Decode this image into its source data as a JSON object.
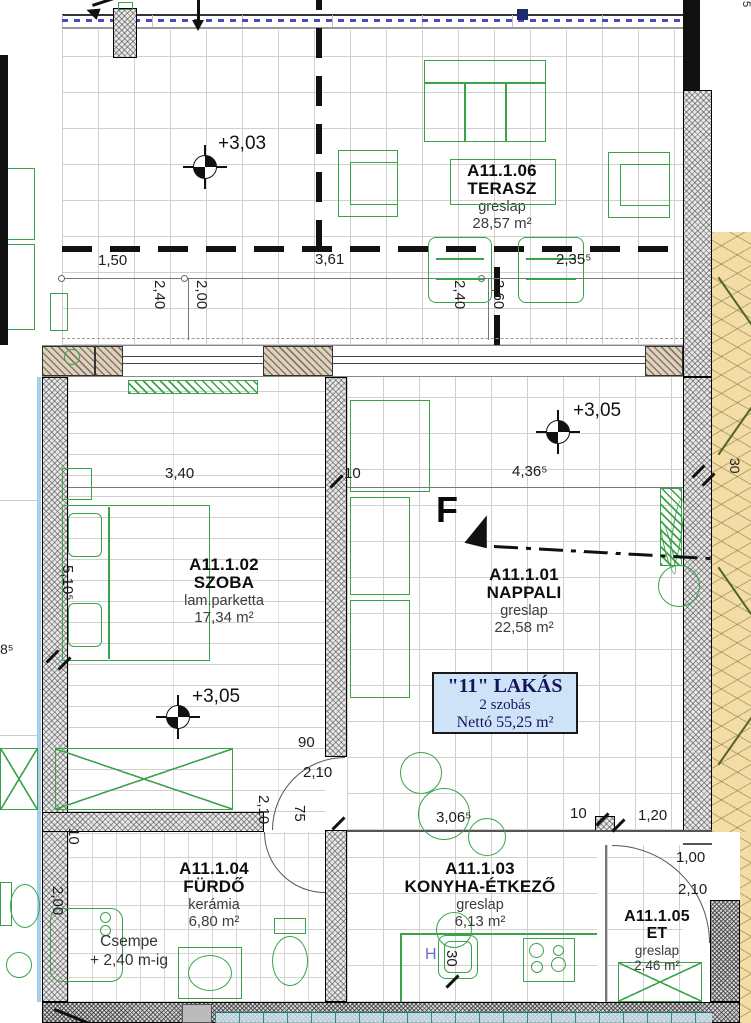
{
  "rooms": [
    {
      "code": "A11.1.06",
      "name": "TERASZ",
      "finish": "greslap",
      "area": "28,57 m²"
    },
    {
      "code": "A11.1.02",
      "name": "SZOBA",
      "finish": "lam.parketta",
      "area": "17,34 m²"
    },
    {
      "code": "A11.1.01",
      "name": "NAPPALI",
      "finish": "greslap",
      "area": "22,58 m²"
    },
    {
      "code": "A11.1.04",
      "name": "FÜRDŐ",
      "finish": "kerámia",
      "area": "6,80 m²"
    },
    {
      "code": "A11.1.03",
      "name": "KONYHA-ÉTKEZŐ",
      "finish": "greslap",
      "area": "6,13 m²"
    },
    {
      "code": "A11.1.05",
      "name": "ET",
      "finish": "greslap",
      "area": "2,46 m²"
    }
  ],
  "apartment_tag": {
    "title": "\"11\" LAKÁS",
    "rooms_count": "2 szobás",
    "net_area": "Nettó 55,25 m²"
  },
  "levels": [
    {
      "label": "+3,03"
    },
    {
      "label": "+3,05"
    },
    {
      "label": "+3,05"
    }
  ],
  "section_marker": {
    "letter": "F"
  },
  "notes": {
    "tiles_line1": "Csempe",
    "tiles_line2": "+ 2,40 m-ig",
    "hot_water": "H"
  },
  "dimensions": [
    {
      "t": "1,50",
      "x": 98,
      "y": 253
    },
    {
      "t": "3,61",
      "x": 315,
      "y": 252
    },
    {
      "t": "2,35⁵",
      "x": 556,
      "y": 252
    },
    {
      "t": "2,40",
      "x": 152,
      "y": 280,
      "v": true
    },
    {
      "t": "2,00",
      "x": 194,
      "y": 280,
      "v": true
    },
    {
      "t": "2,40",
      "x": 452,
      "y": 280,
      "v": true
    },
    {
      "t": "3,60",
      "x": 491,
      "y": 280,
      "v": true
    },
    {
      "t": "3,40",
      "x": 165,
      "y": 466
    },
    {
      "t": "10",
      "x": 344,
      "y": 466
    },
    {
      "t": "4,36⁵",
      "x": 512,
      "y": 464
    },
    {
      "t": "5,10⁵",
      "x": 60,
      "y": 565,
      "v": true
    },
    {
      "t": "90",
      "x": 298,
      "y": 735
    },
    {
      "t": "2,10",
      "x": 303,
      "y": 765
    },
    {
      "t": "2,10",
      "x": 256,
      "y": 795,
      "v": true
    },
    {
      "t": "75",
      "x": 292,
      "y": 805,
      "v": true
    },
    {
      "t": "3,06⁵",
      "x": 436,
      "y": 810
    },
    {
      "t": "10",
      "x": 570,
      "y": 806
    },
    {
      "t": "1,20",
      "x": 638,
      "y": 808
    },
    {
      "t": "1,00",
      "x": 676,
      "y": 850
    },
    {
      "t": "2,10",
      "x": 678,
      "y": 882
    },
    {
      "t": "10",
      "x": 66,
      "y": 828,
      "v": true
    },
    {
      "t": "2,00",
      "x": 50,
      "y": 886,
      "v": true
    },
    {
      "t": "30",
      "x": 444,
      "y": 950,
      "v": true
    },
    {
      "t": "8⁵",
      "x": 0,
      "y": 642,
      "s": 14
    },
    {
      "t": "30",
      "x": 728,
      "y": 458,
      "v": true,
      "s": 14
    },
    {
      "t": "5",
      "x": 740,
      "y": 1,
      "v": true,
      "s": 11
    }
  ],
  "colors": {
    "furniture_green": "#3aa34a",
    "tag_bg": "#cfe3f8",
    "railing_blue": "#4949c8",
    "terrain_tan": "#f4dca6",
    "hot_water_blue": "#6b6bd6"
  }
}
